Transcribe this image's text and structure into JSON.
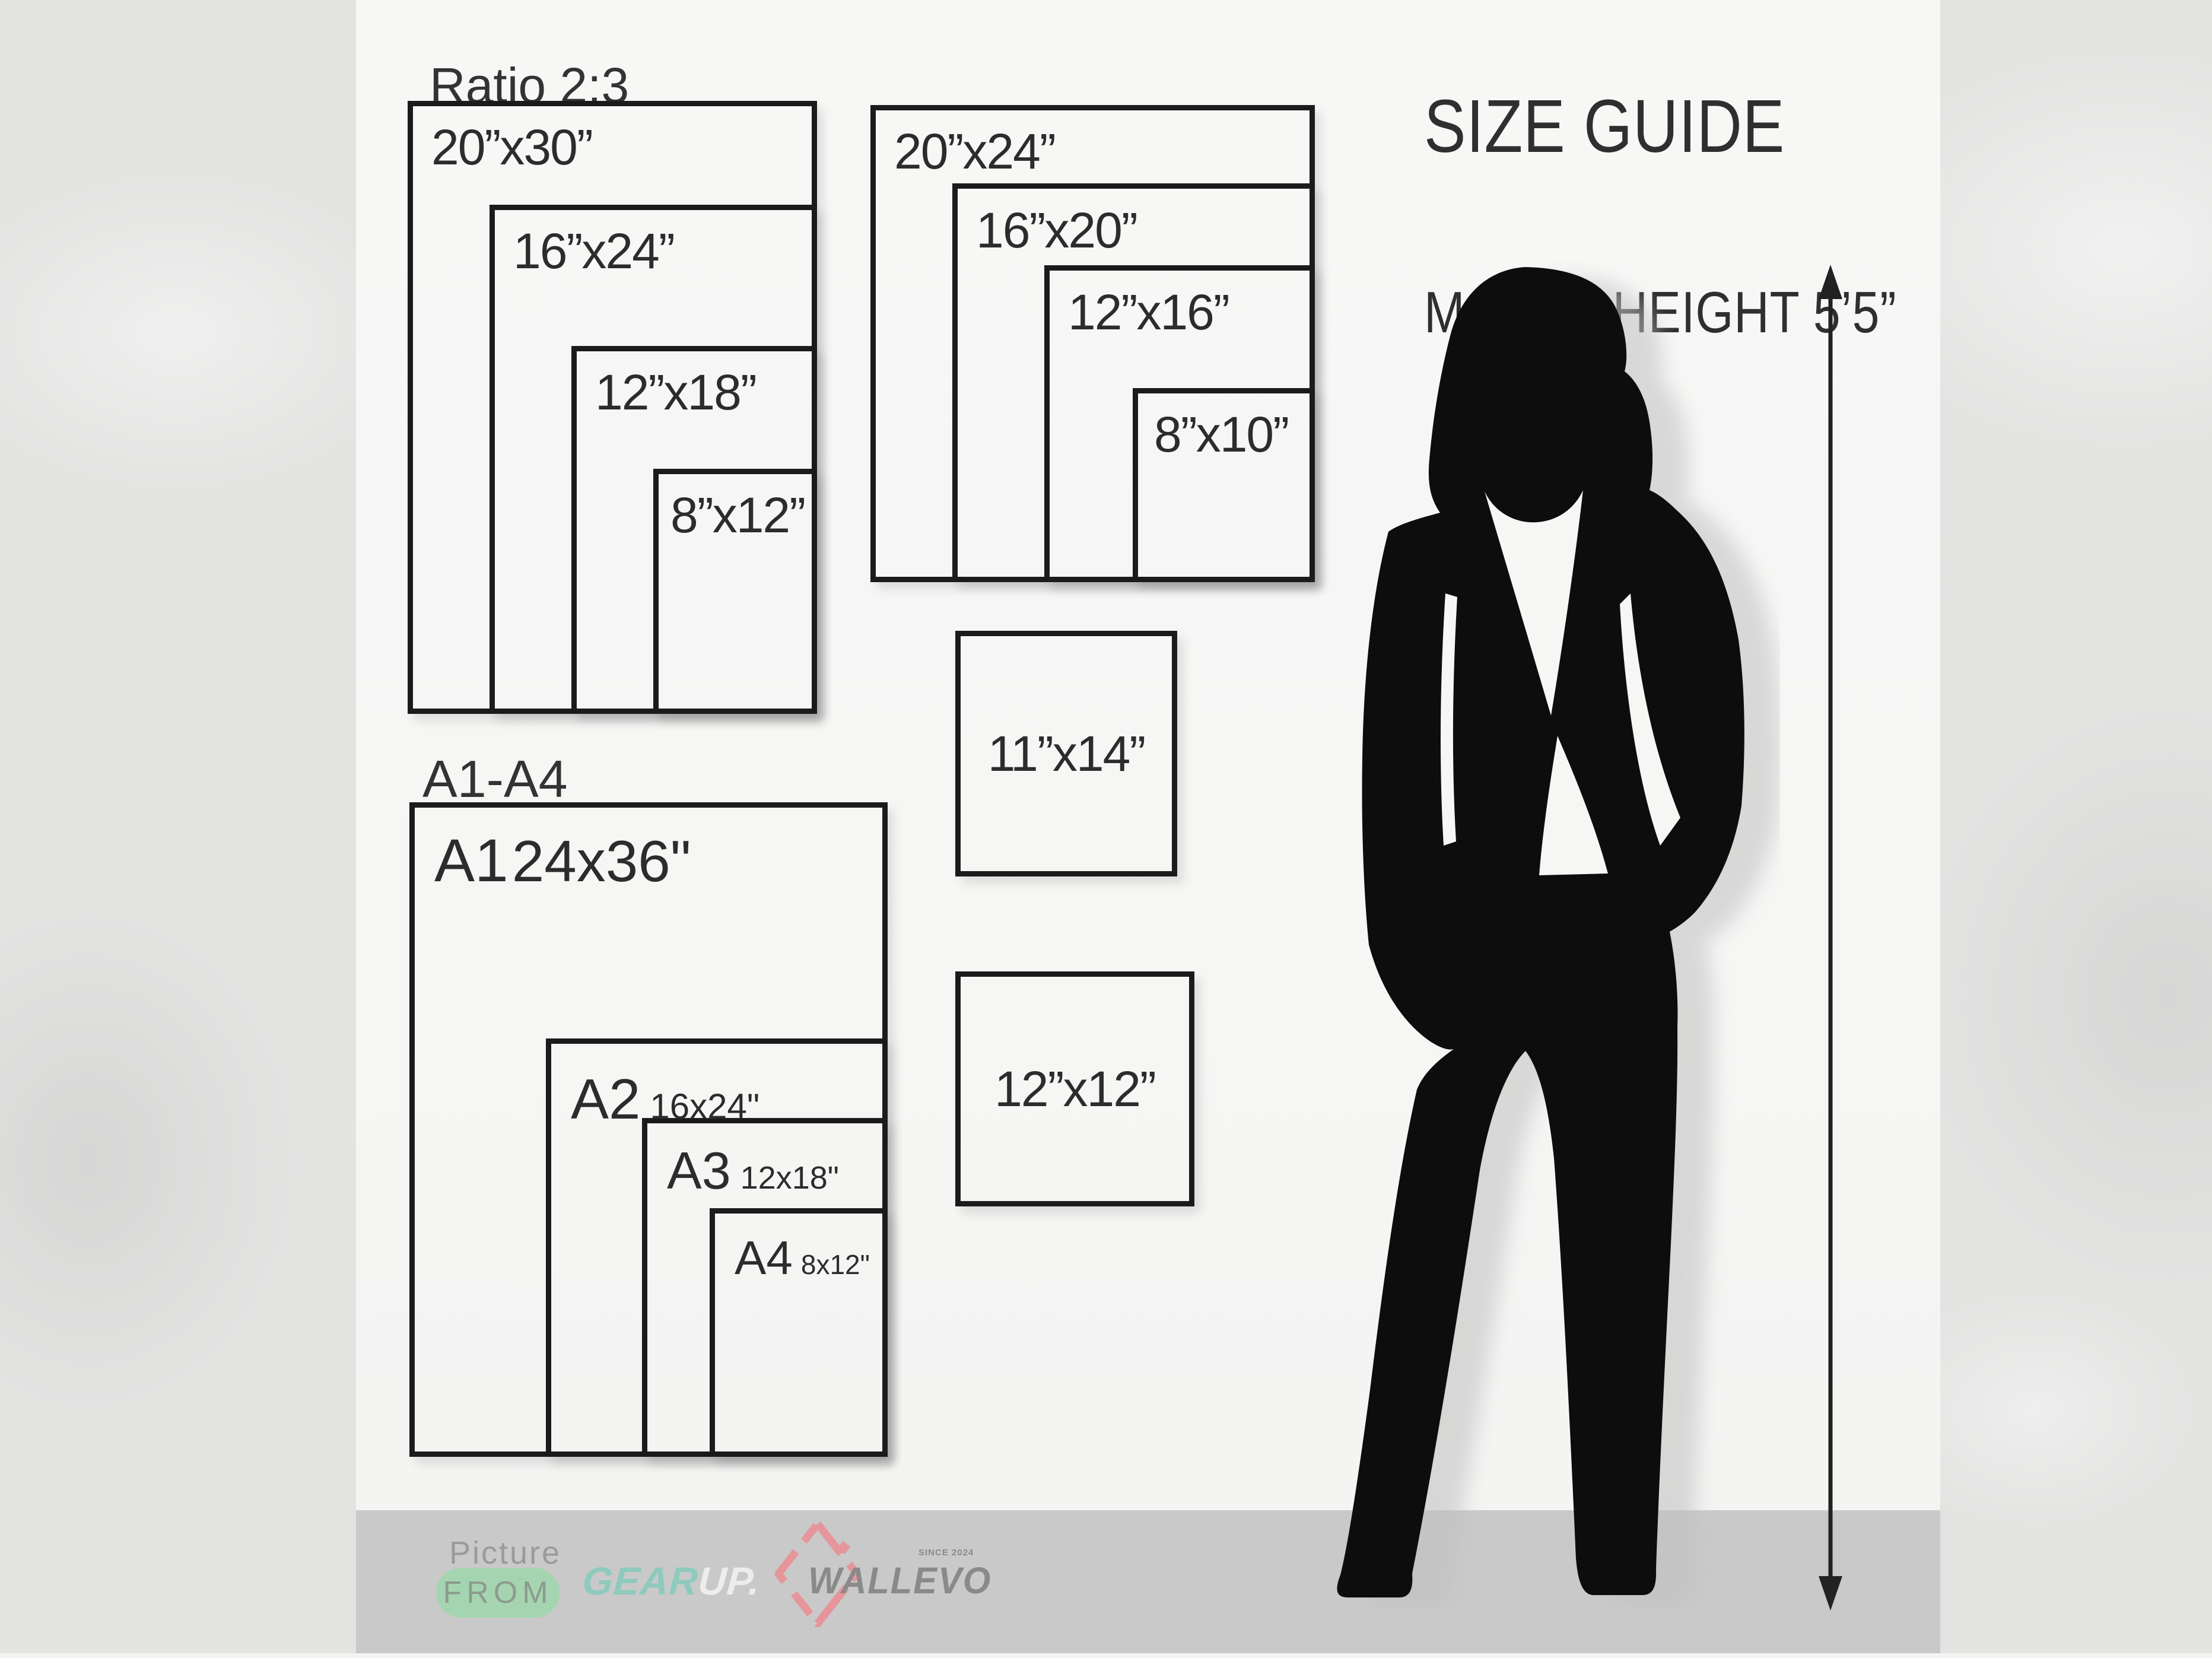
{
  "header": {
    "title": "SIZE GUIDE",
    "model_height": "MODEL HEIGHT 5’5”"
  },
  "ratio_group": {
    "label": "Ratio 2:3",
    "boxes": [
      "20”x30”",
      "16”x24”",
      "12”x18”",
      "8”x12”"
    ]
  },
  "standard_group": {
    "boxes": [
      "20”x24”",
      "16”x20”",
      "12”x16”",
      "8”x10”"
    ]
  },
  "single_boxes": [
    "11”x14”",
    "12”x12”"
  ],
  "a_series": {
    "label": "A1-A4",
    "boxes": [
      {
        "name": "A1",
        "size": "24x36\""
      },
      {
        "name": "A2",
        "size": "16x24\""
      },
      {
        "name": "A3",
        "size": "12x18\""
      },
      {
        "name": "A4",
        "size": "8x12\""
      }
    ]
  },
  "footer": {
    "picture_label": "Picture",
    "from_label": "FROM",
    "logo_gear": "GEAR",
    "logo_up": "UP.",
    "brand": "WALLEVO",
    "since": "SINCE 2024"
  },
  "icons": [
    "model-silhouette",
    "height-double-arrow-icon",
    "diamond-icon"
  ],
  "colors": {
    "accent_green": "#a5d5b0",
    "accent_teal": "#8ecabd",
    "accent_pink": "#e6959b",
    "strip_gray": "#c9c9c9",
    "panel_white": "#f6f6f5",
    "line_black": "#1b1b1b"
  }
}
